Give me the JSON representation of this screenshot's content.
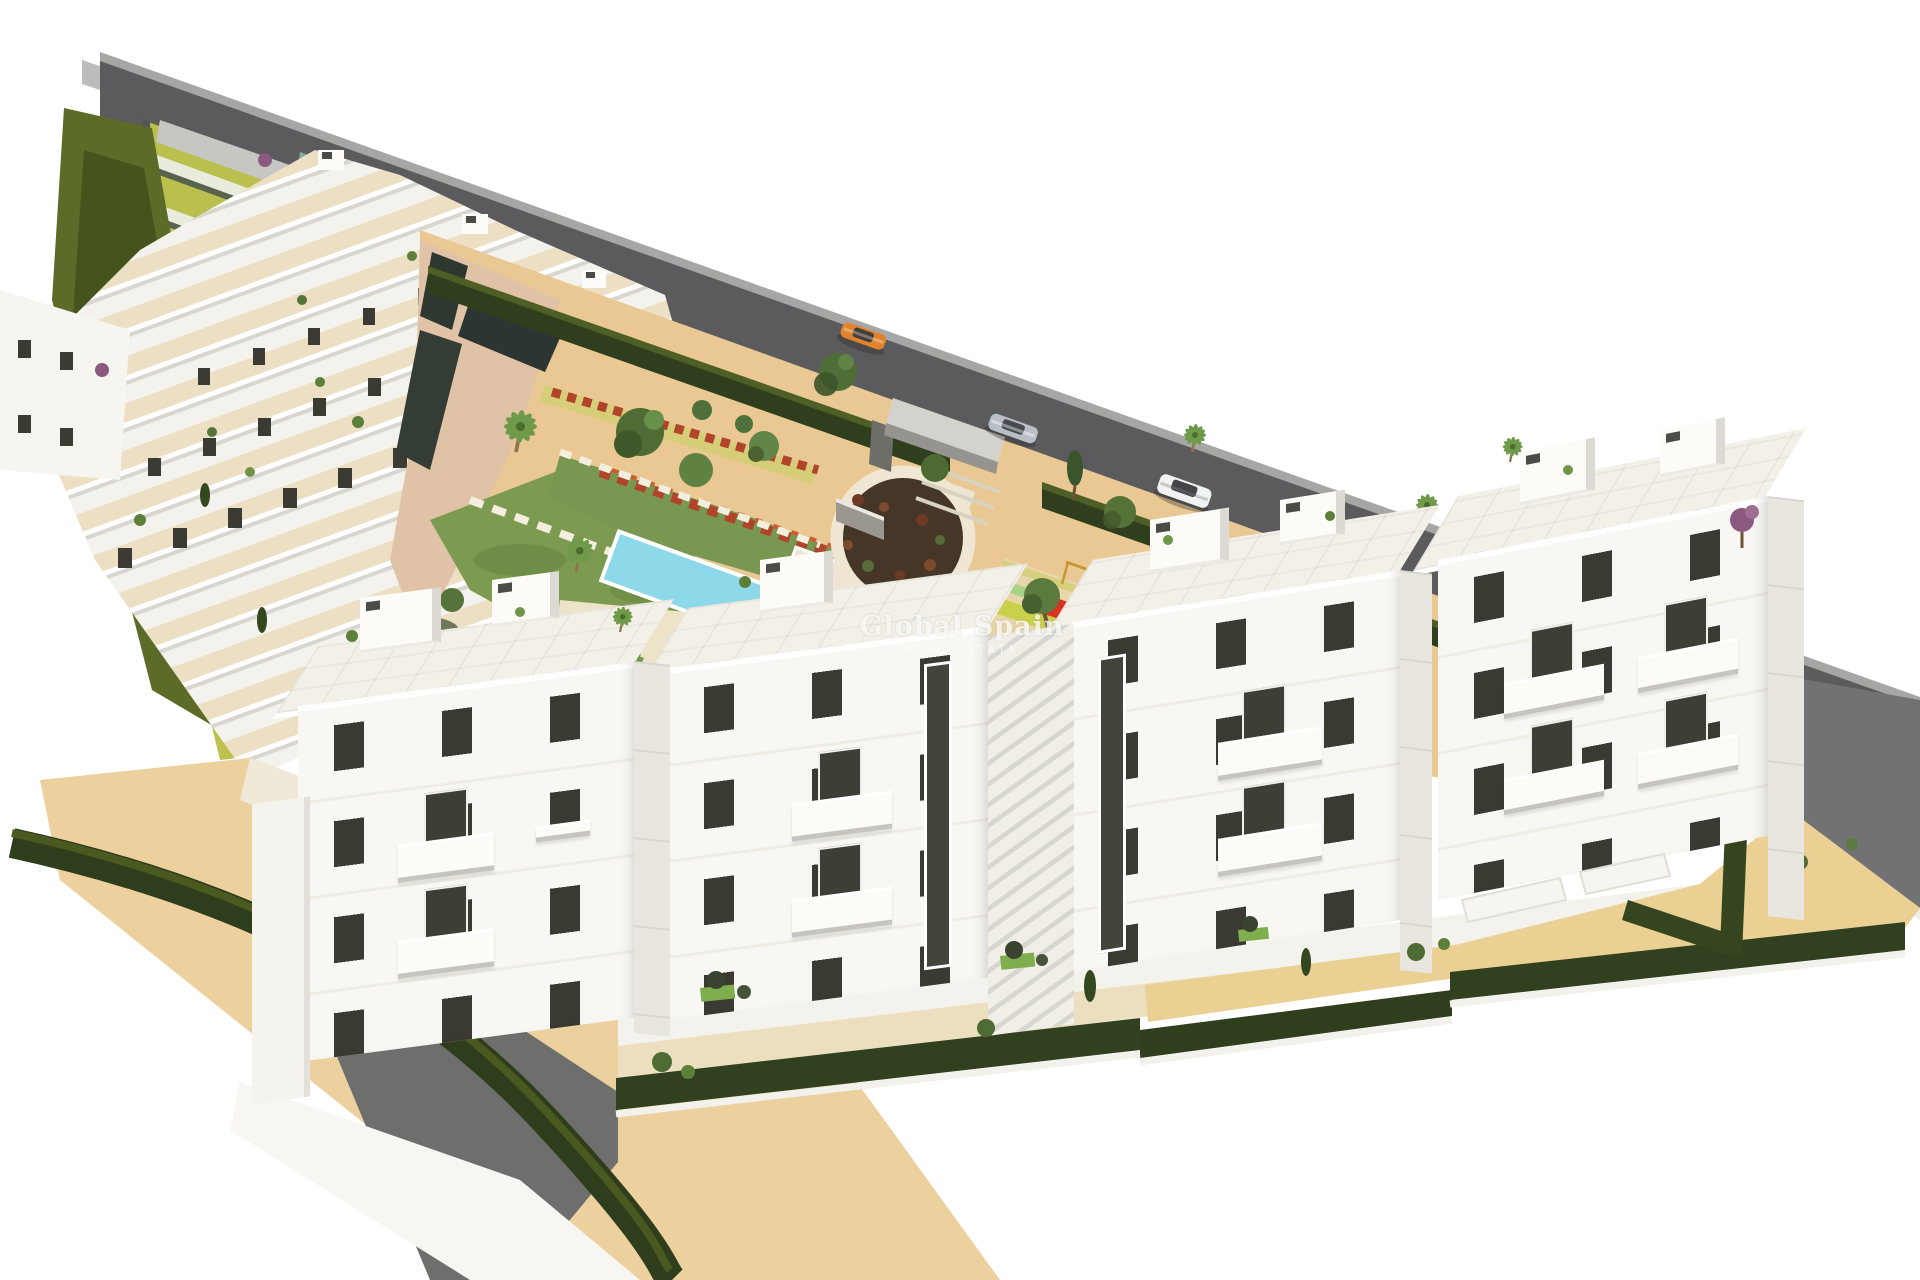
{
  "meta": {
    "description": "Aerial 3D architectural rendering of a white Mediterranean apartment complex with communal gardens, pool, playground and perimeter road",
    "style": "computer-generated real-estate visualization on white background"
  },
  "watermark": {
    "title": "Global Spain",
    "subtitle": "REAL ESTATE"
  },
  "scene": {
    "background": "#ffffff",
    "road": {
      "asphalt": "#5b5b5d",
      "sidewalk": "#bcbcba",
      "curb": "#a6a6a4",
      "retaining_wall": "#727274"
    },
    "hedge": {
      "dark": "#2f3e1c",
      "light": "#4e5f26",
      "hill_olive": "#5c6b27",
      "hill_shadow": "#394618"
    },
    "ground": {
      "sand": "#eac893",
      "plaza_sand": "#ecd09e",
      "path_pink": "#e0c3a6",
      "path_cream": "#efe6cd",
      "accent_yellow": "#d6cd78",
      "shadow_grey": "#6e6e6c"
    },
    "lawn": {
      "main": "#7d9b50",
      "dark": "#5e7d3a"
    },
    "pool": {
      "light": "#8ed9e9",
      "deep": "#3d9fd2",
      "rim": "#ffffff",
      "deck": "#ece3c9"
    },
    "roundabout": {
      "soil": "#463627",
      "ring": "#efe7d3",
      "monument": "#9b978f"
    },
    "playground": {
      "lime": "#c9d04c",
      "green": "#a9d289",
      "mat_red": "#da3220",
      "frame_yellow": "#c59a35"
    },
    "buildings": {
      "facade": "#f8f7f3",
      "side_face": "#e8e6df",
      "window": "#3b3a32",
      "roof": "#f3f0e8",
      "terrace": "#ecdfc4"
    },
    "vegetation": {
      "tree": "#4e6c33",
      "tree_light": "#67904b",
      "palm": "#6f9a4a",
      "cypress": "#33481f",
      "bougainvillea": "#8c5a80",
      "flower_red": "#b0452a"
    },
    "cars": [
      {
        "name": "orange-car",
        "body": "#e0832c"
      },
      {
        "name": "silver-sedan",
        "body": "#b9bfc6"
      },
      {
        "name": "white-suv",
        "body": "#f1f2f3"
      }
    ]
  }
}
